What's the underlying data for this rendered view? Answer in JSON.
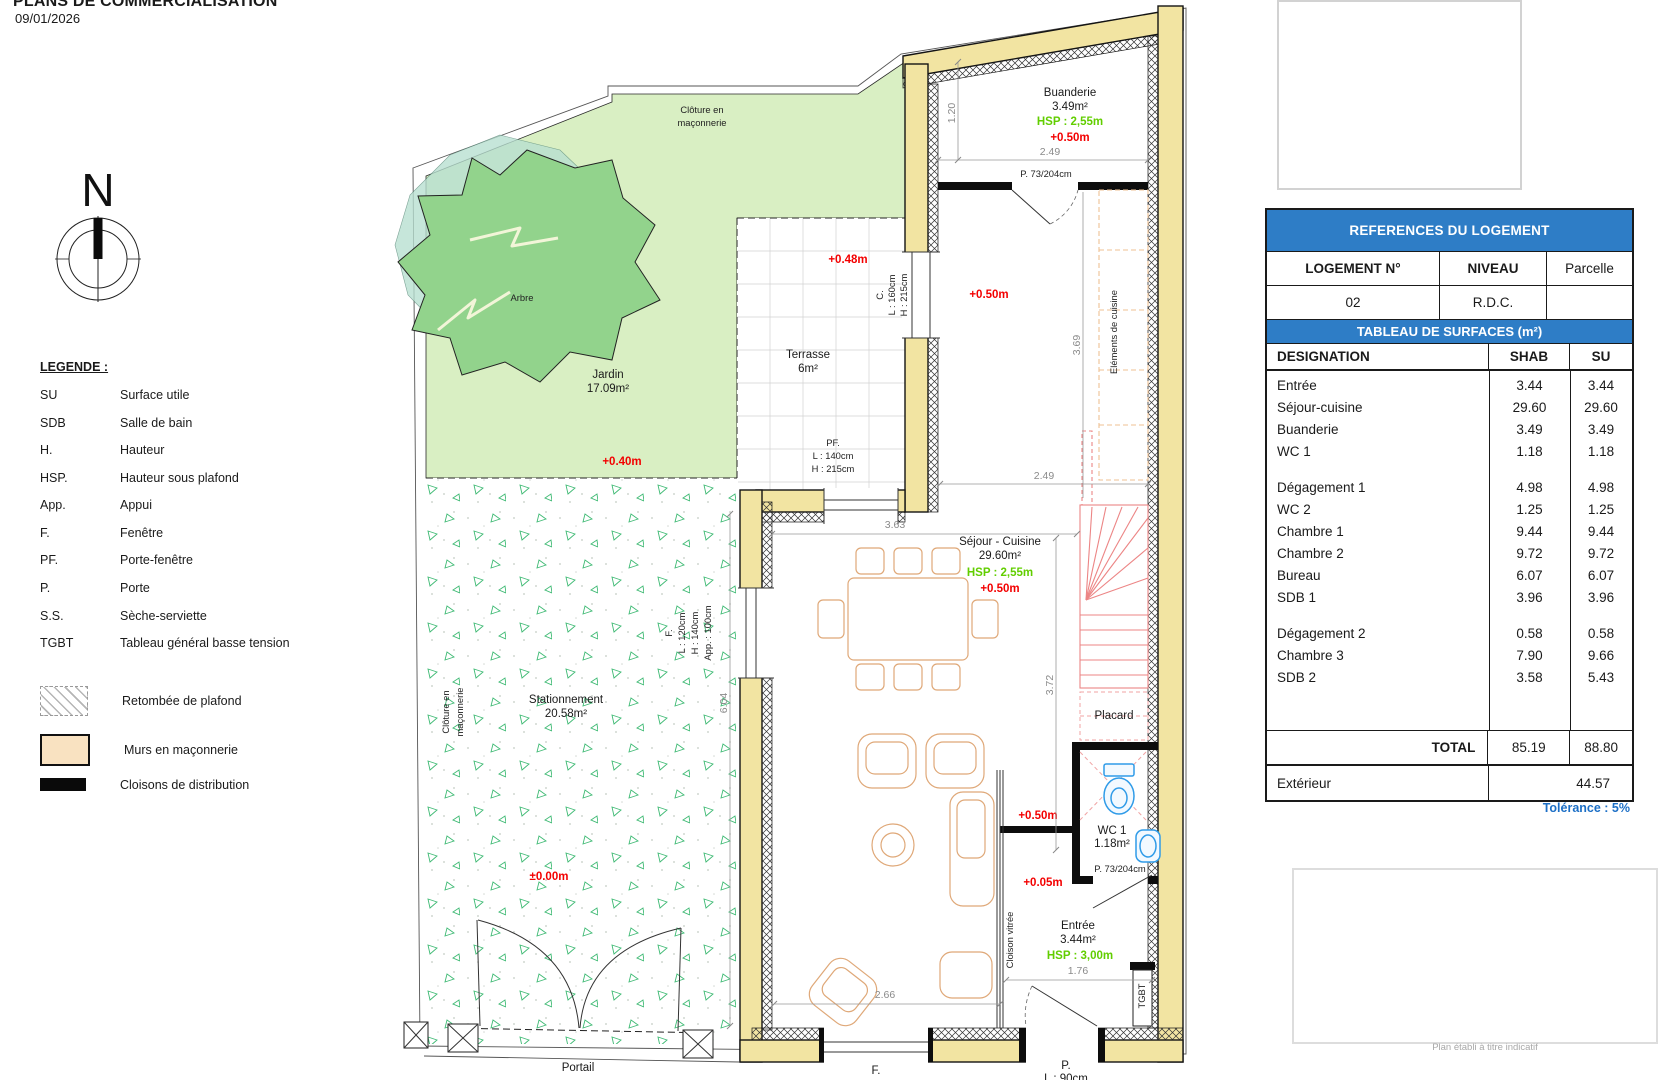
{
  "header": {
    "title": "PLANS DE COMMERCIALISATION",
    "date": "09/01/2026"
  },
  "compass": {
    "north": "N"
  },
  "legend": {
    "title": "LEGENDE :",
    "items": [
      {
        "abbr": "SU",
        "label": "Surface utile"
      },
      {
        "abbr": "SDB",
        "label": "Salle de bain"
      },
      {
        "abbr": "H.",
        "label": "Hauteur"
      },
      {
        "abbr": "HSP.",
        "label": "Hauteur sous plafond"
      },
      {
        "abbr": "App.",
        "label": "Appui"
      },
      {
        "abbr": "F.",
        "label": "Fenêtre"
      },
      {
        "abbr": "PF.",
        "label": "Porte-fenêtre"
      },
      {
        "abbr": "P.",
        "label": "Porte"
      },
      {
        "abbr": "S.S.",
        "label": "Sèche-serviette"
      },
      {
        "abbr": "TGBT",
        "label": "Tableau général basse tension"
      }
    ],
    "swatches": [
      {
        "name": "retombee-plafond",
        "label": "Retombée de plafond"
      },
      {
        "name": "murs-maconnerie",
        "label": "Murs en maçonnerie"
      },
      {
        "name": "cloisons-distribution",
        "label": "Cloisons de distribution"
      }
    ]
  },
  "plan": {
    "site": {
      "cloture_top_1": "Clôture en",
      "cloture_top_2": "maçonnerie",
      "cloture_left_1": "Clôture en",
      "cloture_left_2": "maçonnerie",
      "arbre": "Arbre",
      "jardin_name": "Jardin",
      "jardin_area": "17.09m²",
      "jardin_level": "+0.40m",
      "parking_name": "Stationnement",
      "parking_area": "20.58m²",
      "parking_level": "±0.00m",
      "portail": "Portail"
    },
    "terrasse": {
      "name": "Terrasse",
      "area": "6m²",
      "level": "+0.48m",
      "window_c": "C.",
      "window_c_l": "L : 160cm",
      "window_c_h": "H : 215cm",
      "pf": "PF.",
      "pf_l": "L : 140cm",
      "pf_h": "H : 215cm"
    },
    "buanderie": {
      "name": "Buanderie",
      "area": "3.49m²",
      "hsp": "HSP : 2,55m",
      "level": "+0.50m",
      "door": "P. 73/204cm",
      "dim_w": "2.49",
      "dim_h": "1.20"
    },
    "cuisine": {
      "label": "Eléments de cuisine",
      "level": "+0.50m",
      "dim_h": "3.69",
      "dim_w": "2.49"
    },
    "sejour": {
      "name": "Séjour - Cuisine",
      "area": "29.60m²",
      "hsp": "HSP : 2,55m",
      "level": "+0.50m",
      "dim_363": "3.63",
      "dim_372": "3.72",
      "dim_604": "6.04",
      "dim_266": "2.66"
    },
    "window_f": {
      "label": "F.",
      "l": "L : 120cm",
      "h": "H : 140cm",
      "app": "App. : 100cm"
    },
    "window_f_bottom": "F.",
    "door_p_bottom": {
      "label": "P.",
      "l": "L : 90cm"
    },
    "placard": "Placard",
    "wc": {
      "name": "WC 1",
      "area": "1.18m²",
      "door": "P. 73/204cm",
      "level": "+0.50m",
      "level_low": "+0.05m"
    },
    "entree": {
      "name": "Entrée",
      "area": "3.44m²",
      "hsp": "HSP : 3,00m",
      "dim": "1.76",
      "cloison": "Cloison vitrée",
      "tgbt": "TGBT"
    }
  },
  "tables": {
    "references": {
      "title": "REFERENCES DU LOGEMENT",
      "cols": [
        "LOGEMENT N°",
        "NIVEAU",
        "Parcelle"
      ],
      "values": [
        "02",
        "R.D.C.",
        ""
      ]
    },
    "surfaces": {
      "title": "TABLEAU DE SURFACES (m²)",
      "cols": [
        "DESIGNATION",
        "SHAB",
        "SU"
      ],
      "rows": [
        {
          "label": "Entrée",
          "shab": "3.44",
          "su": "3.44"
        },
        {
          "label": "Séjour-cuisine",
          "shab": "29.60",
          "su": "29.60"
        },
        {
          "label": "Buanderie",
          "shab": "3.49",
          "su": "3.49"
        },
        {
          "label": "WC 1",
          "shab": "1.18",
          "su": "1.18"
        },
        {
          "label": "Dégagement 1",
          "shab": "4.98",
          "su": "4.98",
          "gap": true
        },
        {
          "label": "WC 2",
          "shab": "1.25",
          "su": "1.25"
        },
        {
          "label": "Chambre 1",
          "shab": "9.44",
          "su": "9.44"
        },
        {
          "label": "Chambre 2",
          "shab": "9.72",
          "su": "9.72"
        },
        {
          "label": "Bureau",
          "shab": "6.07",
          "su": "6.07"
        },
        {
          "label": "SDB 1",
          "shab": "3.96",
          "su": "3.96"
        },
        {
          "label": "Dégagement 2",
          "shab": "0.58",
          "su": "0.58",
          "gap": true
        },
        {
          "label": "Chambre 3",
          "shab": "7.90",
          "su": "9.66"
        },
        {
          "label": "SDB 2",
          "shab": "3.58",
          "su": "5.43"
        }
      ],
      "total_label": "TOTAL",
      "total_shab": "85.19",
      "total_su": "88.80",
      "exterior_label": "Extérieur",
      "exterior_value": "44.57",
      "tolerance": "Tolérance : 5%"
    }
  },
  "footer": {
    "note": "Plan établi à titre indicatif"
  }
}
